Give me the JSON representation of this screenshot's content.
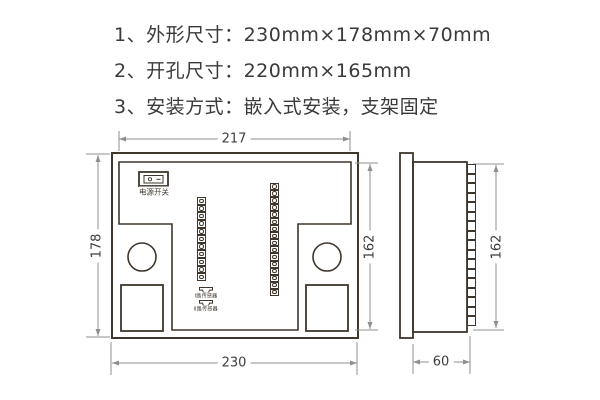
{
  "notes": {
    "line1": "1、外形尺寸：230mm×178mm×70mm",
    "line2": "2、开孔尺寸：220mm×165mm",
    "line3": "3、安装方式：嵌入式安装，支架固定"
  },
  "rear_view": {
    "dim_top": "217",
    "dim_left": "178",
    "dim_right": "162",
    "dim_bottom": "230",
    "power_switch_label": "电源开关",
    "sensor1_label": "Ⅰ路传感器",
    "sensor2_label": "Ⅱ路传感器",
    "left_terminal_count": 11,
    "right_terminal_count": 16
  },
  "side_view": {
    "dim_right": "162",
    "dim_bottom": "60",
    "terminal_count": 17
  },
  "colors": {
    "line_dark": "#3e362c",
    "dim_gray": "#8f8f8f",
    "text": "#3a3a3a"
  }
}
